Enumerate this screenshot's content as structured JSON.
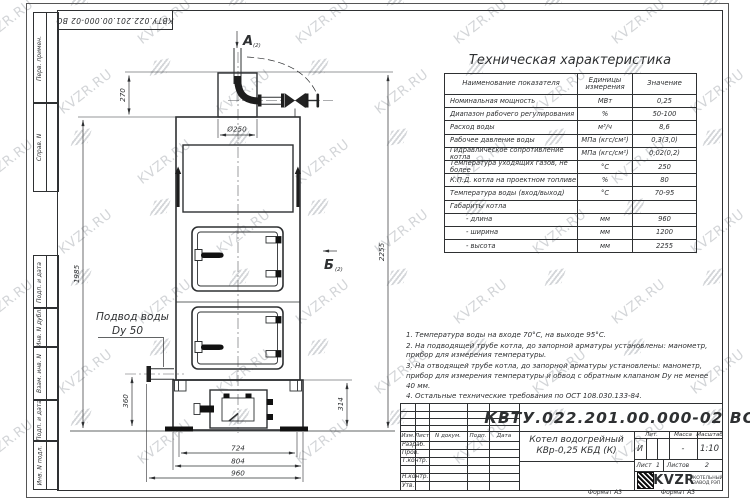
{
  "watermark": {
    "text": "KVZR.RU"
  },
  "corner_stamp": "КВТУ.022.201.00.000-02  ВО",
  "side_columns": {
    "top": [
      "Перв. примен.",
      "Справ. N"
    ],
    "bottom": [
      "Подп. и дата",
      "Инв. N дубл.",
      "Взам. инв. N",
      "Подп. и дата",
      "Инв. N подл."
    ]
  },
  "labels": {
    "view_a": "А",
    "view_b": "Б",
    "sheet_ref": "(2)",
    "water_inlet_line1": "Подвод воды",
    "water_inlet_line2": "Dy 50"
  },
  "dimensions": {
    "d270": "270",
    "d250": "Ø250",
    "d1985": "1985",
    "d2255": "2255",
    "d360": "360",
    "d314": "314",
    "d724": "724",
    "d804": "804",
    "d960": "960"
  },
  "tech_table": {
    "title": "Техническая характеристика",
    "headers": [
      "Наименование показателя",
      "Единицы измерения",
      "Значение"
    ],
    "rows": [
      [
        "Номинальная мощность",
        "МВт",
        "0,25"
      ],
      [
        "Диапазон рабочего регулирования",
        "%",
        "50-100"
      ],
      [
        "Расход воды",
        "м³/ч",
        "8,6"
      ],
      [
        "Рабочее давление воды",
        "МПа (кгс/см²)",
        "0,3(3,0)"
      ],
      [
        "Гидравлическое сопротивление котла",
        "МПа (кгс/см²)",
        "0,02(0,2)"
      ],
      [
        "Температура уходящих газов, не более",
        "°С",
        "250"
      ],
      [
        "К.П.Д. котла на проектном топливе",
        "%",
        "80"
      ],
      [
        "Температура воды (вход/выход)",
        "°С",
        "70-95"
      ],
      [
        "Габариты котла",
        "",
        ""
      ],
      [
        "- длина",
        "мм",
        "960"
      ],
      [
        "- ширина",
        "мм",
        "1200"
      ],
      [
        "- высота",
        "мм",
        "2255"
      ]
    ]
  },
  "notes": [
    "1.  Температура воды на входе  70°С, на выходе  95°С.",
    "2.  На подводящей трубе котла, до запорной арматуры установлены: манометр, прибор для измерения температуры.",
    "3.  На отводящей трубе котла, до запорной арматуры установлены: манометр, прибор для измерения температуры и обвод с обратным клапаном Dу не менее 40 мм.",
    "4.  Остальные технические требования по ОСТ  108.030.133-84."
  ],
  "title_block": {
    "doc_number": "КВТУ.022.201.00.000-02  ВО",
    "product_title_1": "Котел водогрейный",
    "product_title_2": "КВр-0,25  КБД  (К)",
    "cols": [
      "Изм.",
      "Лист",
      "N докум.",
      "Подп.",
      "Дата"
    ],
    "rows": [
      "Разраб.",
      "Пров.",
      "Т.контр.",
      "Н.контр.",
      "Утв."
    ],
    "lit_header": "Лит.",
    "mass_header": "Масса",
    "scale_header": "Масштаб",
    "lit_value": "И",
    "mass_value": "-",
    "scale_value": "1:10",
    "sheet_label": "Лист",
    "sheet_value": "1",
    "sheets_label": "Листов",
    "sheets_value": "2",
    "company_logo": "KVZR",
    "company_name_1": "КОТЕЛЬНЫЙ",
    "company_name_2": "ЗАВОД РЭП",
    "format_label": "Формат А3"
  }
}
